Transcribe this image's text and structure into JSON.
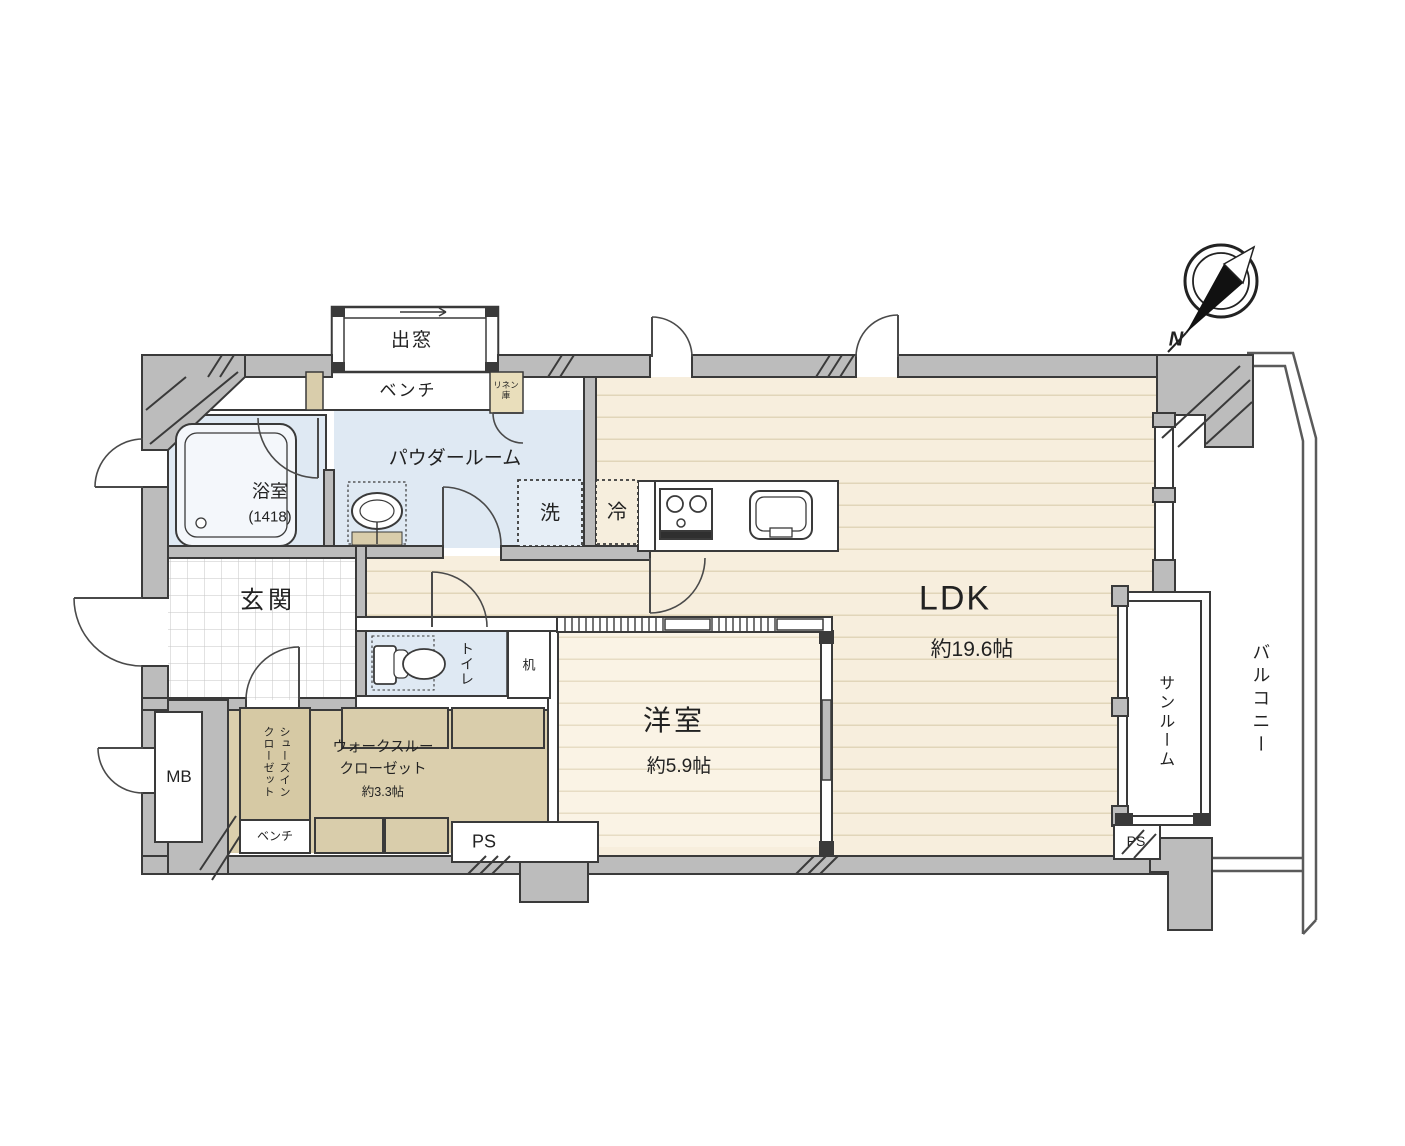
{
  "plan": {
    "compass": {
      "north_label": "N"
    },
    "rooms": {
      "ldk": {
        "name": "LDK",
        "size": "約19.6帖"
      },
      "western_room": {
        "name": "洋室",
        "size": "約5.9帖"
      },
      "walk_through_closet": {
        "line1": "ウォークスルー",
        "line2": "クローゼット",
        "size": "約3.3帖"
      },
      "shoes_in_closet": {
        "line1": "シューズイン",
        "line2": "クローゼット"
      },
      "powder_room": {
        "name": "パウダールーム"
      },
      "bathroom": {
        "name": "浴室",
        "size": "(1418)"
      },
      "genkan": {
        "name": "玄関"
      },
      "toilet": {
        "name": "トイレ"
      },
      "sunroom": {
        "name": "サンルーム"
      },
      "balcony": {
        "name": "バルコニー"
      }
    },
    "fixtures": {
      "bay_window": "出窓",
      "bench_top": "ベンチ",
      "bench_bottom": "ベンチ",
      "linen_closet": "リネン庫",
      "washer": "洗",
      "fridge": "冷",
      "desk": "机",
      "meter_box": "MB",
      "pipe_space_center": "PS",
      "pipe_space_right": "PS"
    },
    "colors": {
      "wall": "#bcbcbc",
      "outline": "#3a3a3a",
      "wood_floor": "#f7eedd",
      "wood_floor_light": "#faf3e5",
      "wet_area": "#dfe9f3",
      "closet_tan": "#dbcfad",
      "cabinet_tan": "#d9cdab"
    }
  }
}
